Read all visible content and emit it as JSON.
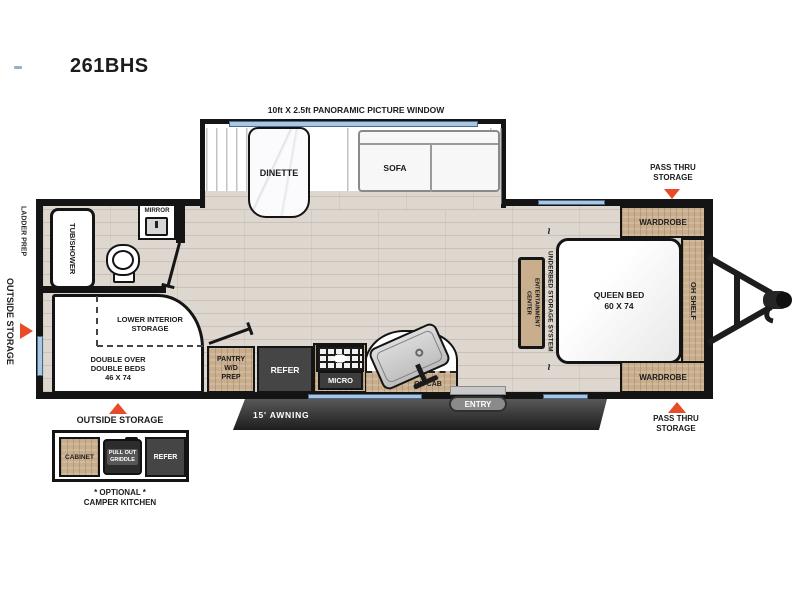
{
  "title": "261BHS",
  "slideout": {
    "window_label": "10ft X 2.5ft PANORAMIC PICTURE WINDOW",
    "dinette": "DINETTE",
    "sofa": "SOFA"
  },
  "bedroom": {
    "pass_thru_storage_top": "PASS THRU\nSTORAGE",
    "pass_thru_storage_bottom": "PASS THRU\nSTORAGE",
    "wardrobe": "WARDROBE",
    "queen_bed": "QUEEN BED\n60 X 74",
    "oh_shelf": "OH SHELF",
    "underbed_storage": "UNDERBED STORAGE SYSTEM",
    "entertainment_center": "ENTERTAINMENT\nCENTER",
    "squiggle": "~"
  },
  "bathroom": {
    "tub_shower": "TUB/SHOWER",
    "mirror": "MIRROR"
  },
  "bunk_room": {
    "lower_interior_storage": "LOWER INTERIOR\nSTORAGE",
    "double_beds": "DOUBLE OVER\nDOUBLE BEDS\n46 X 74"
  },
  "kitchen": {
    "pantry": "PANTRY\nW/D\nPREP",
    "refer": "REFER",
    "micro": "MICRO",
    "oh_cab": "OH CAB"
  },
  "exterior": {
    "ladder_prep": "LADDER PREP",
    "outside_storage_side": "OUTSIDE STORAGE",
    "outside_storage_bottom": "OUTSIDE STORAGE",
    "awning": "15' AWNING",
    "entry": "ENTRY"
  },
  "camper_kitchen": {
    "cabinet": "CABINET",
    "pull_out_griddle": "PULL OUT\nGRIDDLE",
    "refer": "REFER",
    "caption": "* OPTIONAL *\nCAMPER KITCHEN"
  },
  "colors": {
    "accent_orange": "#e84b28",
    "window_blue": "#a9c7e2",
    "wood": "#c9ae8d",
    "wall_black": "#141414",
    "appliance_dark": "#454545"
  }
}
